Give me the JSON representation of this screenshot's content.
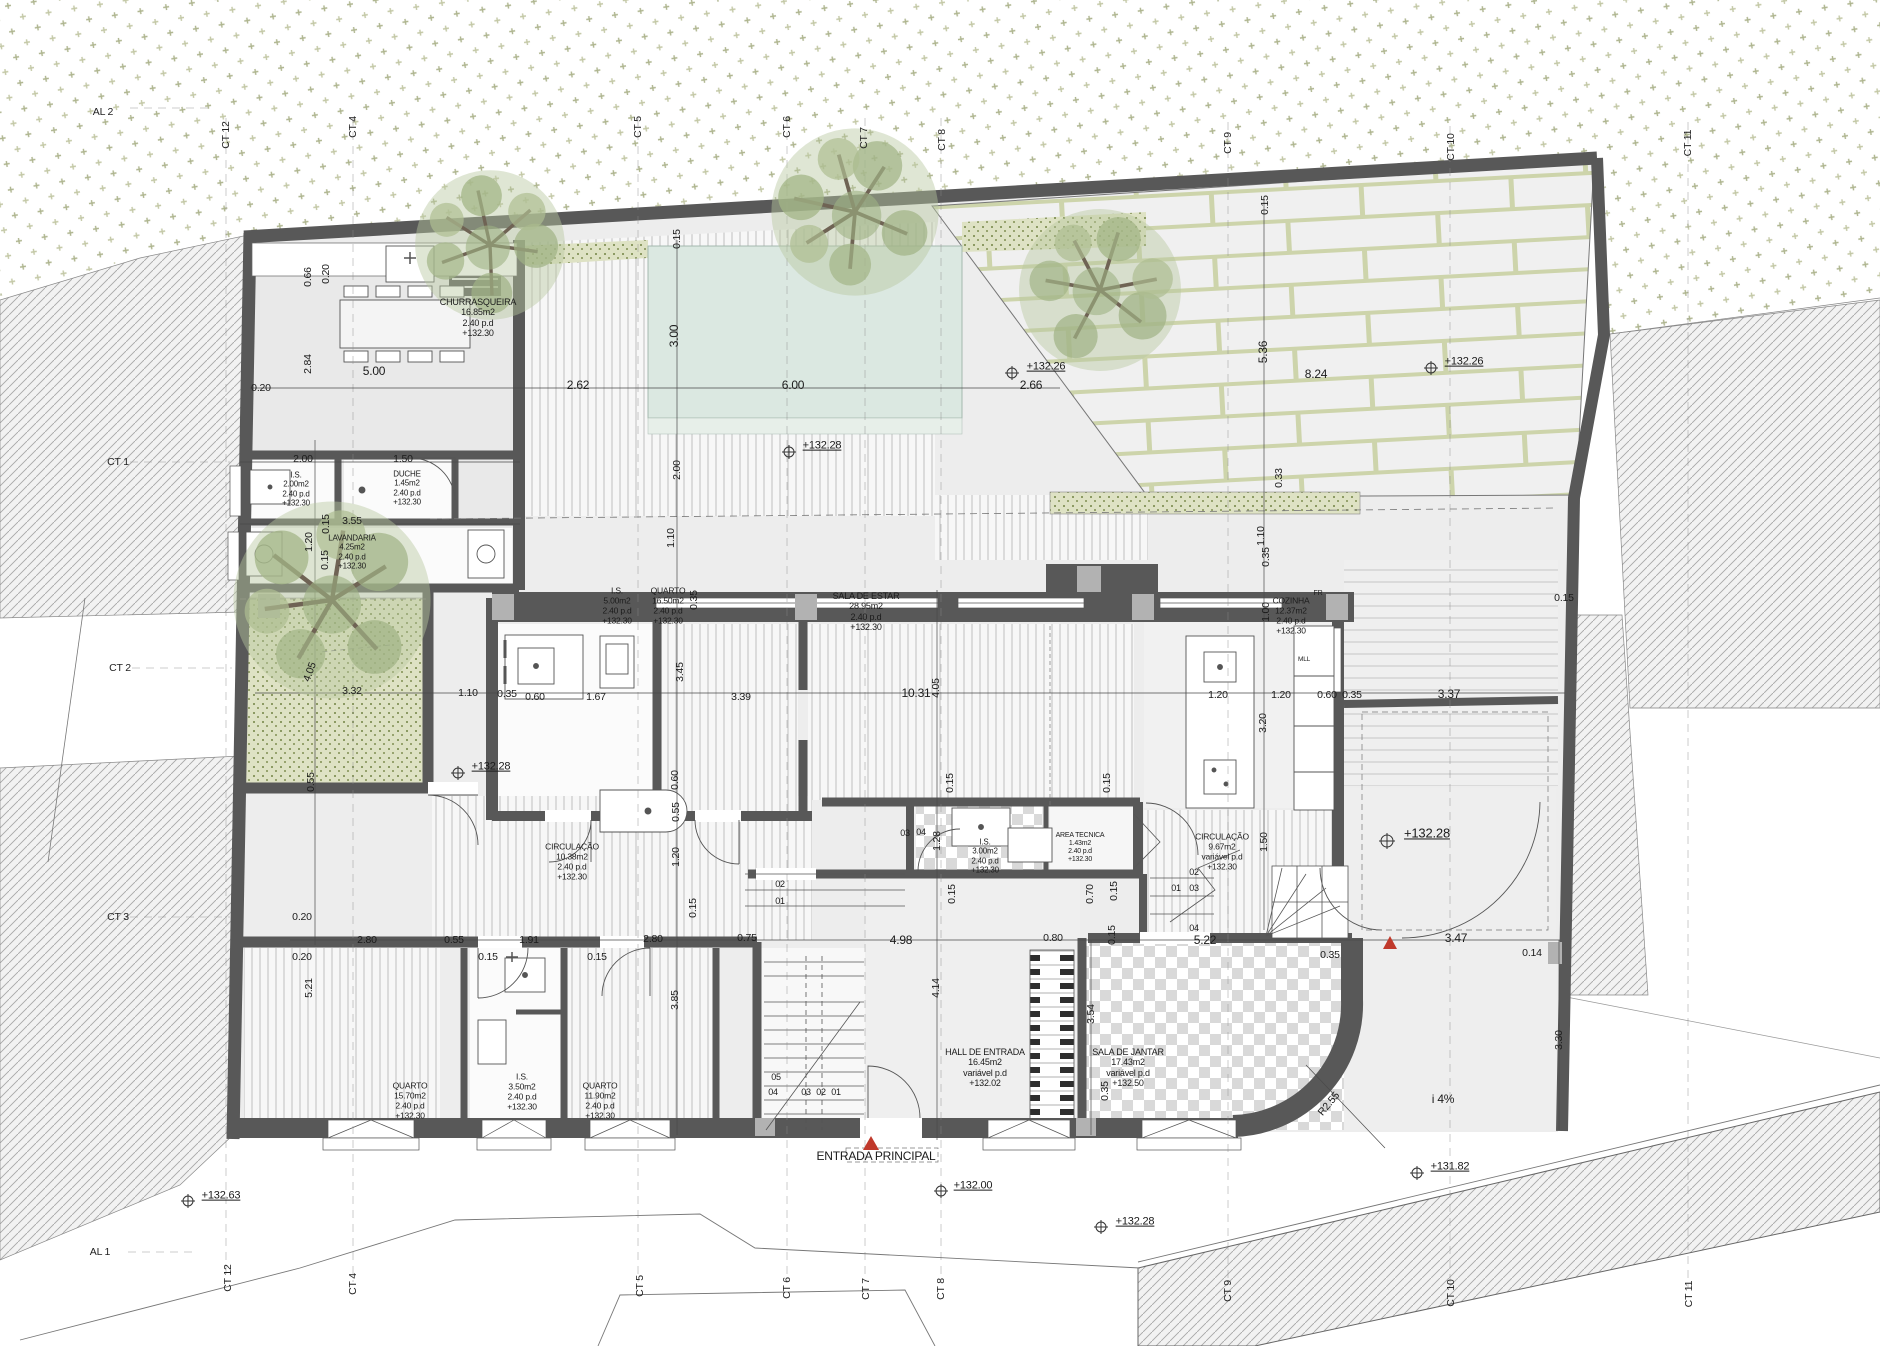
{
  "meta": {
    "width": 1880,
    "height": 1346,
    "drawing_type": "architectural floor plan"
  },
  "colors": {
    "wall": "#585858",
    "floor": "#ededed",
    "pool": "#dbe8e1",
    "terrain_mark": "#9aa273",
    "hedge_bg": "#dee2c4",
    "hedge_dot": "#8c9a63",
    "hatch": "#a8a8a8",
    "accent_red": "#c0392b",
    "deck_line": "#bfbfbf",
    "checker": "#d9d9d9",
    "slab": "#f0f0f0",
    "slab_joint": "#cdd4ab"
  },
  "axis_labels": [
    {
      "n": "axis-al-2",
      "t": "AL 2",
      "x": 103,
      "y": 112,
      "r": 0
    },
    {
      "n": "axis-ct-12-top",
      "t": "CT 12",
      "x": 226,
      "y": 135,
      "r": -90
    },
    {
      "n": "axis-ct-4-top",
      "t": "CT 4",
      "x": 353,
      "y": 127,
      "r": -90
    },
    {
      "n": "axis-ct-5-top",
      "t": "CT 5",
      "x": 638,
      "y": 127,
      "r": -90
    },
    {
      "n": "axis-ct-6-top",
      "t": "CT 6",
      "x": 787,
      "y": 127,
      "r": -90
    },
    {
      "n": "axis-ct-7-top",
      "t": "CT 7",
      "x": 864,
      "y": 138,
      "r": -90
    },
    {
      "n": "axis-ct-8-top",
      "t": "CT 8",
      "x": 942,
      "y": 140,
      "r": -90
    },
    {
      "n": "axis-ct-9-top",
      "t": "CT 9",
      "x": 1228,
      "y": 143,
      "r": -90
    },
    {
      "n": "axis-ct-10-top",
      "t": "CT 10",
      "x": 1451,
      "y": 147,
      "r": -90
    },
    {
      "n": "axis-ct-11-top",
      "t": "CT 11",
      "x": 1688,
      "y": 143,
      "r": -90
    },
    {
      "n": "axis-ct-1",
      "t": "CT 1",
      "x": 118,
      "y": 462,
      "r": 0
    },
    {
      "n": "axis-ct-2",
      "t": "CT 2",
      "x": 120,
      "y": 668,
      "r": 0
    },
    {
      "n": "axis-ct-3",
      "t": "CT 3",
      "x": 118,
      "y": 917,
      "r": 0
    },
    {
      "n": "axis-al-1",
      "t": "AL 1",
      "x": 100,
      "y": 1252,
      "r": 0
    },
    {
      "n": "axis-ct-12-bot",
      "t": "CT 12",
      "x": 228,
      "y": 1278,
      "r": -90
    },
    {
      "n": "axis-ct-4-bot",
      "t": "CT 4",
      "x": 353,
      "y": 1284,
      "r": -90
    },
    {
      "n": "axis-ct-5-bot",
      "t": "CT 5",
      "x": 640,
      "y": 1286,
      "r": -90
    },
    {
      "n": "axis-ct-6-bot",
      "t": "CT 6",
      "x": 787,
      "y": 1288,
      "r": -90
    },
    {
      "n": "axis-ct-7-bot",
      "t": "CT 7",
      "x": 866,
      "y": 1289,
      "r": -90
    },
    {
      "n": "axis-ct-8-bot",
      "t": "CT 8",
      "x": 941,
      "y": 1289,
      "r": -90
    },
    {
      "n": "axis-ct-9-bot",
      "t": "CT 9",
      "x": 1228,
      "y": 1291,
      "r": -90
    },
    {
      "n": "axis-ct-10-bot",
      "t": "CT 10",
      "x": 1451,
      "y": 1293,
      "r": -90
    },
    {
      "n": "axis-ct-11-bot",
      "t": "CT 11",
      "x": 1689,
      "y": 1294,
      "r": -90
    }
  ],
  "room_labels": [
    {
      "n": "room-churrasqueira",
      "t": "CHURRASQUEIRA\n16.85m2\n2.40 p.d\n+132.30",
      "x": 478,
      "y": 318,
      "fs": 9
    },
    {
      "n": "room-is-200",
      "t": "I.S.\n2.00m2\n2.40 p.d\n+132.30",
      "x": 296,
      "y": 489,
      "fs": 8
    },
    {
      "n": "room-duche",
      "t": "DUCHE\n1.45m2\n2.40 p.d\n+132.30",
      "x": 407,
      "y": 488,
      "fs": 8
    },
    {
      "n": "room-lavandaria",
      "t": "LAVANDARIA\n4.25m2\n2.40 p.d\n+132.30",
      "x": 352,
      "y": 552,
      "fs": 8
    },
    {
      "n": "room-is-500",
      "t": "I.S.\n5.00m2\n2.40 p.d\n+132.30",
      "x": 617,
      "y": 606,
      "fs": 8.5
    },
    {
      "n": "room-quarto-1650",
      "t": "QUARTO\n16.50m2\n2.40 p.d\n+132.30",
      "x": 668,
      "y": 606,
      "fs": 8.5
    },
    {
      "n": "room-sala-de-estar",
      "t": "SALA DE ESTAR\n28.95m2\n2.40 p.d\n+132.30",
      "x": 866,
      "y": 612,
      "fs": 9
    },
    {
      "n": "room-cozinha",
      "t": "COZINHA\n12.37m2\n2.40 p.d\n+132.30",
      "x": 1291,
      "y": 616,
      "fs": 8.5
    },
    {
      "n": "room-circulacao-1038",
      "t": "CIRCULAÇÃO\n10.38m2\n2.40 p.d\n+132.30",
      "x": 572,
      "y": 862,
      "fs": 8.5
    },
    {
      "n": "room-is-300",
      "t": "I.S.\n3.00m2\n2.40 p.d\n+132.30",
      "x": 985,
      "y": 856,
      "fs": 8
    },
    {
      "n": "room-area-tecnica",
      "t": "AREA TECNICA\n1.43m2\n2.40 p.d\n+132.30",
      "x": 1080,
      "y": 848,
      "fs": 7
    },
    {
      "n": "room-circulacao-967",
      "t": "CIRCULAÇÃO\n9.67m2\nvariável p.d\n+132.30",
      "x": 1222,
      "y": 852,
      "fs": 8.5
    },
    {
      "n": "room-quarto-1570",
      "t": "QUARTO\n15.70m2\n2.40 p.d\n+132.30",
      "x": 410,
      "y": 1101,
      "fs": 8.5
    },
    {
      "n": "room-is-350",
      "t": "I.S.\n3.50m2\n2.40 p.d\n+132.30",
      "x": 522,
      "y": 1092,
      "fs": 8.5
    },
    {
      "n": "room-quarto-1190",
      "t": "QUARTO\n11.90m2\n2.40 p.d\n+132.30",
      "x": 600,
      "y": 1101,
      "fs": 8.5
    },
    {
      "n": "room-hall-de-entrada",
      "t": "HALL DE ENTRADA\n16.45m2\nvariável p.d\n+132.02",
      "x": 985,
      "y": 1068,
      "fs": 9
    },
    {
      "n": "room-sala-de-jantar",
      "t": "SALA DE JANTAR\n17.43m2\nvariável p.d\n+132.50",
      "x": 1128,
      "y": 1068,
      "fs": 9
    }
  ],
  "dim_labels": [
    {
      "t": "0.66",
      "x": 308,
      "y": 277,
      "r": -90
    },
    {
      "t": "0.20",
      "x": 326,
      "y": 274,
      "r": -90
    },
    {
      "t": "2.84",
      "x": 308,
      "y": 364,
      "r": -90
    },
    {
      "t": "5.00",
      "x": 374,
      "y": 372,
      "r": 0,
      "fs": 12
    },
    {
      "t": "0.20",
      "x": 261,
      "y": 388,
      "r": 0
    },
    {
      "t": "2.00",
      "x": 303,
      "y": 459,
      "r": 0
    },
    {
      "t": "1.50",
      "x": 403,
      "y": 459,
      "r": 0
    },
    {
      "t": "0.15",
      "x": 326,
      "y": 524,
      "r": -90
    },
    {
      "t": "3.55",
      "x": 352,
      "y": 521,
      "r": 0
    },
    {
      "t": "1.20",
      "x": 309,
      "y": 542,
      "r": -90
    },
    {
      "t": "0.15",
      "x": 325,
      "y": 560,
      "r": -90
    },
    {
      "t": "2.62",
      "x": 578,
      "y": 386,
      "r": 0,
      "fs": 12
    },
    {
      "t": "6.00",
      "x": 793,
      "y": 386,
      "r": 0,
      "fs": 12
    },
    {
      "t": "2.66",
      "x": 1031,
      "y": 386,
      "r": 0,
      "fs": 12
    },
    {
      "t": "3.00",
      "x": 675,
      "y": 336,
      "r": -90,
      "fs": 12
    },
    {
      "t": "0.15",
      "x": 677,
      "y": 239,
      "r": -90
    },
    {
      "t": "2.00",
      "x": 677,
      "y": 470,
      "r": -90
    },
    {
      "t": "5.36",
      "x": 1264,
      "y": 352,
      "r": -90,
      "fs": 12
    },
    {
      "t": "8.24",
      "x": 1316,
      "y": 375,
      "r": 0,
      "fs": 12
    },
    {
      "t": "0.15",
      "x": 1265,
      "y": 205,
      "r": -90
    },
    {
      "t": "0.33",
      "x": 1279,
      "y": 478,
      "r": -90
    },
    {
      "t": "1.10",
      "x": 671,
      "y": 538,
      "r": -90
    },
    {
      "t": "1.10",
      "x": 1261,
      "y": 536,
      "r": -90
    },
    {
      "t": "0.35",
      "x": 1266,
      "y": 557,
      "r": -90
    },
    {
      "t": "4.05",
      "x": 310,
      "y": 672,
      "r": -70
    },
    {
      "t": "3.32",
      "x": 352,
      "y": 691,
      "r": 0
    },
    {
      "t": "1.10",
      "x": 468,
      "y": 693,
      "r": 0
    },
    {
      "t": "0.35",
      "x": 507,
      "y": 694,
      "r": 0
    },
    {
      "t": "0.60",
      "x": 535,
      "y": 697,
      "r": 0
    },
    {
      "t": "1.67",
      "x": 596,
      "y": 697,
      "r": 0
    },
    {
      "t": "3.39",
      "x": 741,
      "y": 697,
      "r": 0
    },
    {
      "t": "3.45",
      "x": 680,
      "y": 672,
      "r": -90
    },
    {
      "t": "0.35",
      "x": 694,
      "y": 600,
      "r": -90
    },
    {
      "t": "10.31",
      "x": 916,
      "y": 694,
      "r": 0,
      "fs": 12
    },
    {
      "t": "4.05",
      "x": 936,
      "y": 688,
      "r": -90
    },
    {
      "t": "1.20",
      "x": 1218,
      "y": 695,
      "r": 0
    },
    {
      "t": "1.20",
      "x": 1281,
      "y": 695,
      "r": 0
    },
    {
      "t": "0.60",
      "x": 1327,
      "y": 695,
      "r": 0
    },
    {
      "t": "0.35",
      "x": 1352,
      "y": 695,
      "r": 0
    },
    {
      "t": "3.37",
      "x": 1449,
      "y": 695,
      "r": 0,
      "fs": 12
    },
    {
      "t": "0.15",
      "x": 1564,
      "y": 598,
      "r": 0
    },
    {
      "t": "1.00",
      "x": 1266,
      "y": 612,
      "r": -90
    },
    {
      "t": "3.20",
      "x": 1263,
      "y": 723,
      "r": -90
    },
    {
      "t": "0.15",
      "x": 950,
      "y": 783,
      "r": -90
    },
    {
      "t": "0.15",
      "x": 1107,
      "y": 783,
      "r": -90
    },
    {
      "t": "0.55",
      "x": 311,
      "y": 782,
      "r": -90
    },
    {
      "t": "0.20",
      "x": 302,
      "y": 917,
      "r": 0
    },
    {
      "t": "5.21",
      "x": 309,
      "y": 988,
      "r": -90
    },
    {
      "t": "0.60",
      "x": 675,
      "y": 780,
      "r": -90
    },
    {
      "t": "0.55",
      "x": 676,
      "y": 812,
      "r": -90
    },
    {
      "t": "1.20",
      "x": 676,
      "y": 857,
      "r": -90
    },
    {
      "t": "0.15",
      "x": 693,
      "y": 908,
      "r": -90
    },
    {
      "t": "1.28",
      "x": 937,
      "y": 841,
      "r": -90
    },
    {
      "t": "0.15",
      "x": 952,
      "y": 894,
      "r": -90
    },
    {
      "t": "0.70",
      "x": 1090,
      "y": 894,
      "r": -90
    },
    {
      "t": "0.15",
      "x": 1114,
      "y": 891,
      "r": -90
    },
    {
      "t": "0.15",
      "x": 1112,
      "y": 935,
      "r": -90
    },
    {
      "t": "1.50",
      "x": 1264,
      "y": 842,
      "r": -90
    },
    {
      "t": "0.20",
      "x": 302,
      "y": 957,
      "r": 0
    },
    {
      "t": "2.80",
      "x": 367,
      "y": 940,
      "r": 0
    },
    {
      "t": "0.55",
      "x": 454,
      "y": 940,
      "r": 0
    },
    {
      "t": "1.91",
      "x": 529,
      "y": 940,
      "r": 0
    },
    {
      "t": "0.15",
      "x": 488,
      "y": 957,
      "r": 0
    },
    {
      "t": "0.15",
      "x": 597,
      "y": 957,
      "r": 0
    },
    {
      "t": "2.80",
      "x": 653,
      "y": 939,
      "r": 0
    },
    {
      "t": "0.75",
      "x": 747,
      "y": 938,
      "r": 0
    },
    {
      "t": "3.85",
      "x": 675,
      "y": 1000,
      "r": -90
    },
    {
      "t": "4.98",
      "x": 901,
      "y": 941,
      "r": 0,
      "fs": 12
    },
    {
      "t": "0.80",
      "x": 1053,
      "y": 938,
      "r": 0
    },
    {
      "t": "4.14",
      "x": 936,
      "y": 988,
      "r": -90
    },
    {
      "t": "3.54",
      "x": 1091,
      "y": 1014,
      "r": -90
    },
    {
      "t": "0.35",
      "x": 1105,
      "y": 1091,
      "r": -90
    },
    {
      "t": "5.22",
      "x": 1205,
      "y": 941,
      "r": 0,
      "fs": 12
    },
    {
      "t": "0.35",
      "x": 1330,
      "y": 955,
      "r": 0
    },
    {
      "t": "3.47",
      "x": 1456,
      "y": 939,
      "r": 0,
      "fs": 12
    },
    {
      "t": "0.14",
      "x": 1532,
      "y": 953,
      "r": 0
    },
    {
      "t": "3.30",
      "x": 1559,
      "y": 1040,
      "r": -90
    },
    {
      "t": "R2.55",
      "x": 1329,
      "y": 1104,
      "r": -50
    }
  ],
  "stair_numbers": [
    {
      "t": "05",
      "x": 776,
      "y": 1077
    },
    {
      "t": "04",
      "x": 773,
      "y": 1092
    },
    {
      "t": "03",
      "x": 806,
      "y": 1092
    },
    {
      "t": "02",
      "x": 821,
      "y": 1092
    },
    {
      "t": "01",
      "x": 836,
      "y": 1092
    },
    {
      "t": "02",
      "x": 780,
      "y": 884
    },
    {
      "t": "01",
      "x": 780,
      "y": 901
    },
    {
      "t": "03",
      "x": 905,
      "y": 833
    },
    {
      "t": "04",
      "x": 921,
      "y": 832
    },
    {
      "t": "02",
      "x": 1194,
      "y": 872
    },
    {
      "t": "01",
      "x": 1176,
      "y": 888
    },
    {
      "t": "03",
      "x": 1194,
      "y": 888
    },
    {
      "t": "04",
      "x": 1194,
      "y": 928
    }
  ],
  "level_markers": [
    {
      "n": "level-132-26-pool",
      "t": "+132.26",
      "x": 1046,
      "y": 367,
      "mx": 1012,
      "my": 373
    },
    {
      "n": "level-132-26-garden",
      "t": "+132.26",
      "x": 1464,
      "y": 362,
      "mx": 1431,
      "my": 368
    },
    {
      "n": "level-132-28-terrace",
      "t": "+132.28",
      "x": 822,
      "y": 446,
      "mx": 789,
      "my": 452
    },
    {
      "n": "level-132-28-courtyard",
      "t": "+132.28",
      "x": 491,
      "y": 767,
      "mx": 458,
      "my": 773
    },
    {
      "n": "level-132-28-entry",
      "t": "+132.28",
      "x": 1427,
      "y": 833,
      "mx": 1387,
      "my": 841,
      "fs": 13
    },
    {
      "n": "level-132-28-bottom",
      "t": "+132.28",
      "x": 1135,
      "y": 1222,
      "mx": 1101,
      "my": 1227
    },
    {
      "n": "level-132-00",
      "t": "+132.00",
      "x": 973,
      "y": 1186,
      "mx": 941,
      "my": 1191
    },
    {
      "n": "level-132-63",
      "t": "+132.63",
      "x": 221,
      "y": 1196,
      "mx": 188,
      "my": 1201
    },
    {
      "n": "level-131-82",
      "t": "+131.82",
      "x": 1450,
      "y": 1167,
      "mx": 1417,
      "my": 1173
    }
  ],
  "misc_labels": [
    {
      "n": "entrance-label",
      "t": "ENTRADA PRINCIPAL",
      "x": 876,
      "y": 1157,
      "fs": 12
    },
    {
      "n": "slope-label",
      "t": "i  4%",
      "x": 1443,
      "y": 1100,
      "fs": 12
    },
    {
      "n": "fridge-label",
      "t": "FR",
      "x": 1318,
      "y": 594,
      "fs": 7
    },
    {
      "n": "dishwasher-label",
      "t": "MLL",
      "x": 1304,
      "y": 660,
      "fs": 6.5
    }
  ]
}
